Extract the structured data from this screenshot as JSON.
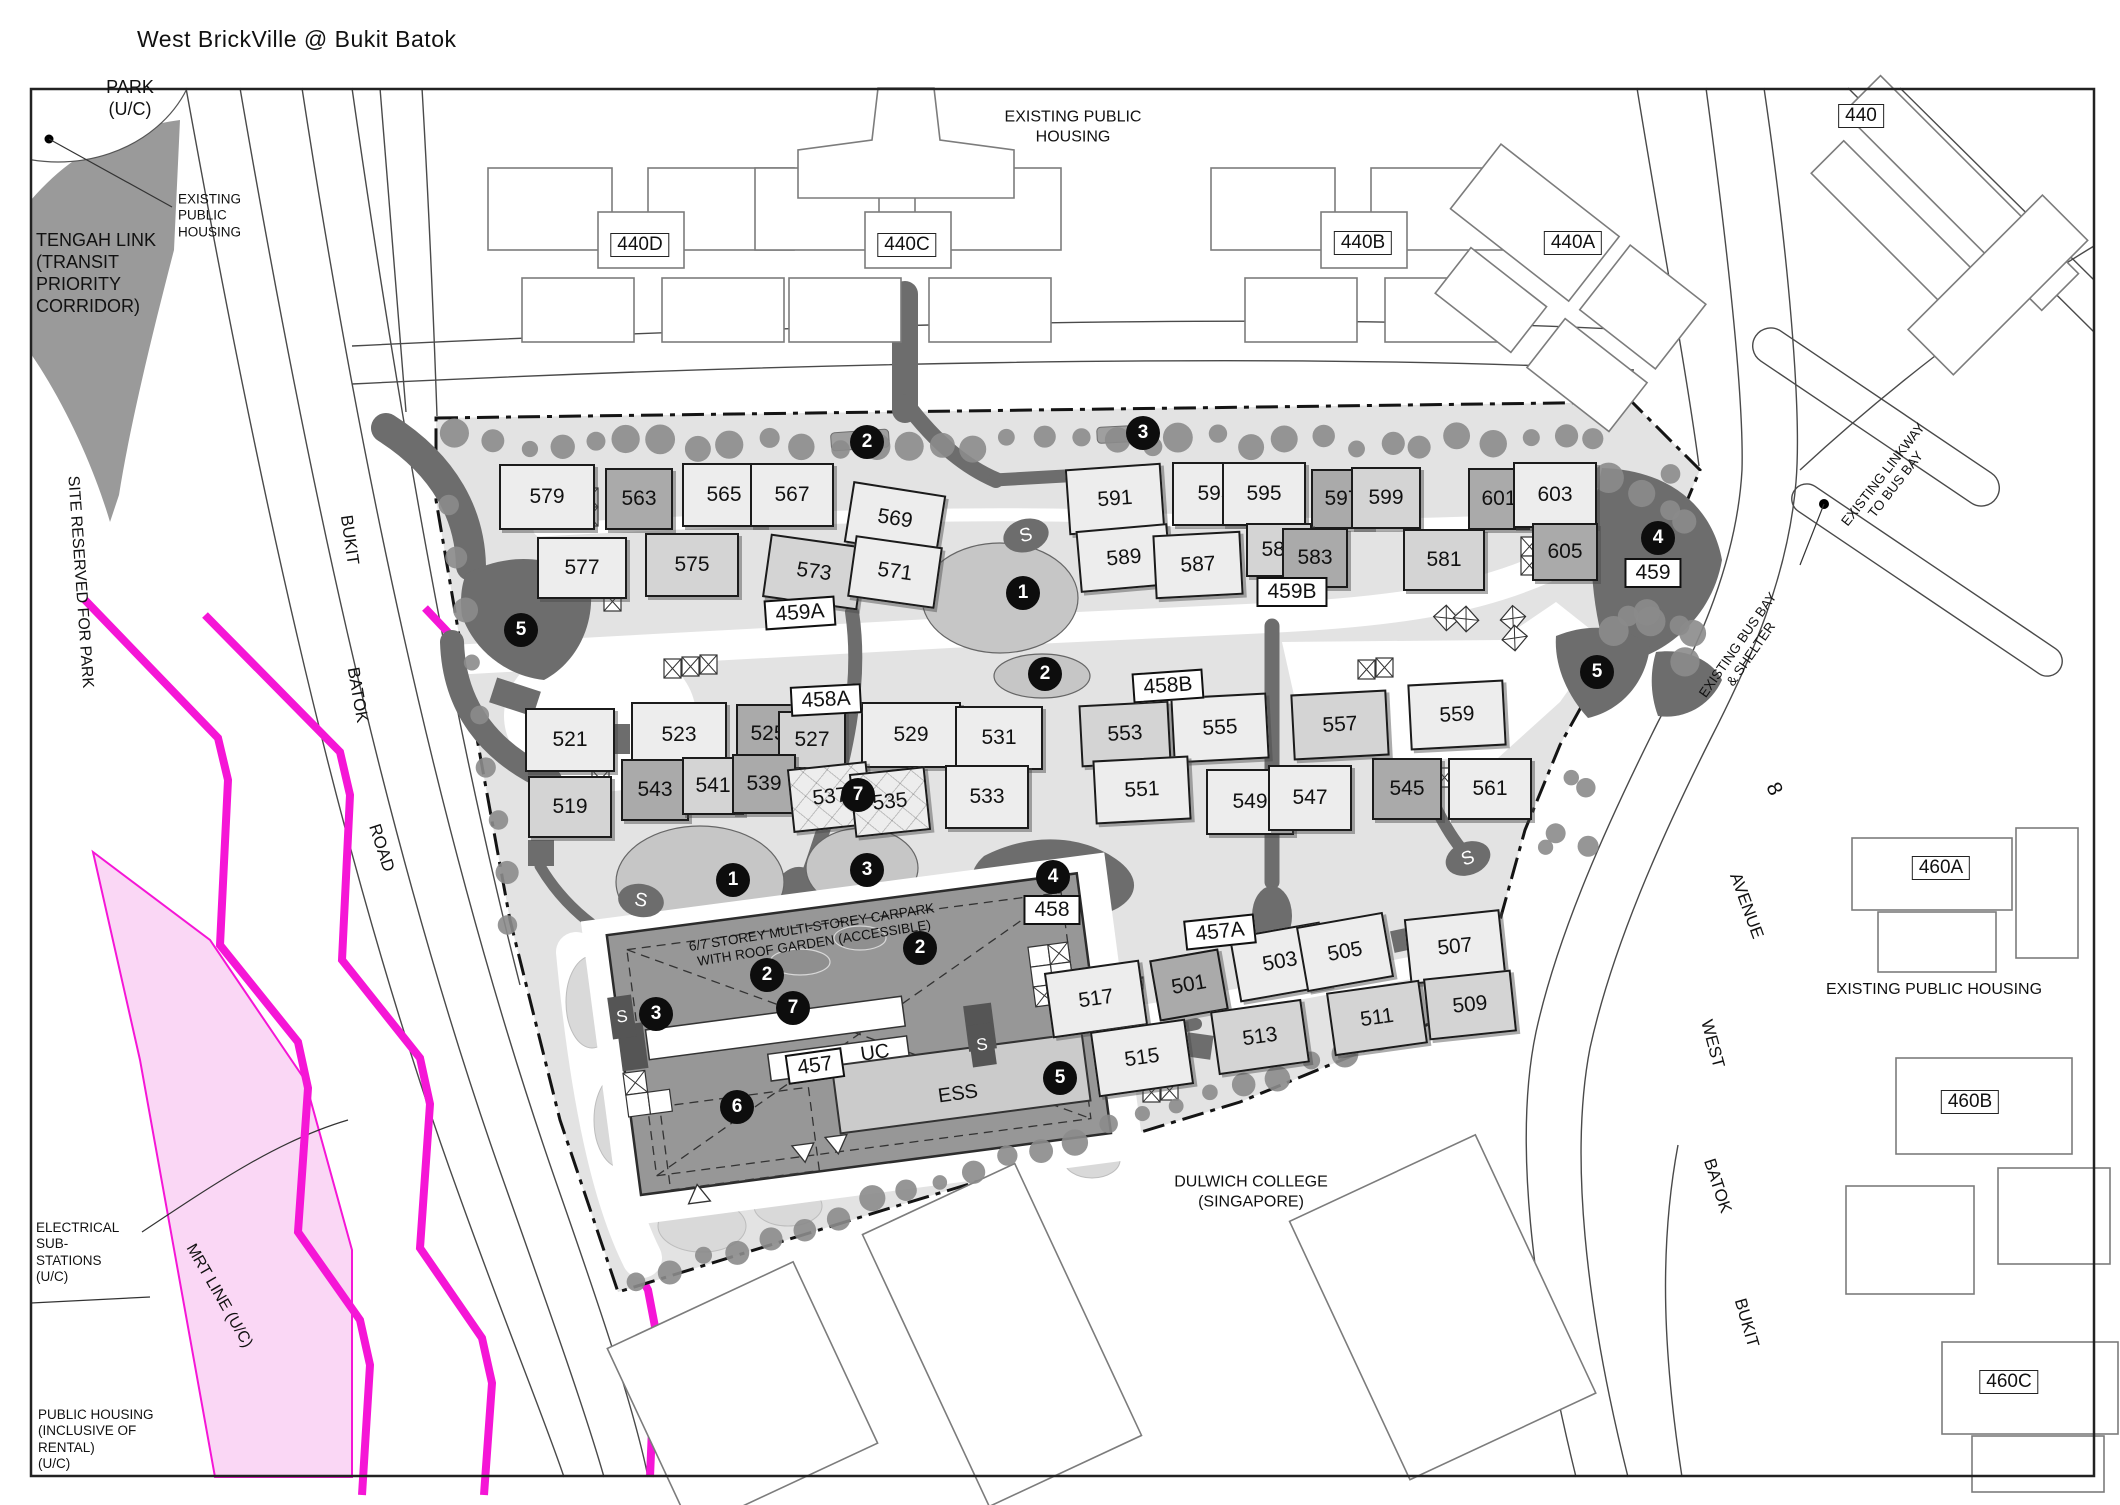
{
  "title": "West BrickVille @ Bukit Batok",
  "colors": {
    "mrt_line": "#f516d6",
    "mrt_band": "#fad7f5",
    "tengah_gray": "#9a9a9a",
    "site_fill": "#e3e3e3",
    "path_dark": "#6d6d6d",
    "tree": "#8b8b8b",
    "marker_bg": "#0d0d0d"
  },
  "s_label": "S",
  "labels": [
    {
      "id": "park",
      "lines": [
        "PARK",
        "(U/C)"
      ],
      "x": 130,
      "y": 99,
      "size": 18,
      "rot": 0,
      "align": "center"
    },
    {
      "id": "tengah-link",
      "lines": [
        "TENGAH LINK",
        "(TRANSIT",
        "PRIORITY",
        "CORRIDOR)"
      ],
      "x": 36,
      "y": 274,
      "size": 18,
      "rot": 0,
      "align": "left"
    },
    {
      "id": "existing-public-housing-callout",
      "lines": [
        "EXISTING",
        "PUBLIC",
        "HOUSING"
      ],
      "x": 178,
      "y": 216,
      "size": 13.5,
      "rot": 0,
      "align": "left"
    },
    {
      "id": "site-reserved-for-park",
      "lines": [
        "SITE RESERVED FOR PARK"
      ],
      "x": 80,
      "y": 582,
      "size": 16,
      "rot": 86,
      "align": "center"
    },
    {
      "id": "bukit-left",
      "lines": [
        "BUKIT"
      ],
      "x": 349,
      "y": 540,
      "size": 17,
      "rot": 82,
      "align": "center"
    },
    {
      "id": "batok-left",
      "lines": [
        "BATOK"
      ],
      "x": 357,
      "y": 695,
      "size": 17,
      "rot": 80,
      "align": "center"
    },
    {
      "id": "road-left",
      "lines": [
        "ROAD"
      ],
      "x": 381,
      "y": 848,
      "size": 17,
      "rot": 72,
      "align": "center"
    },
    {
      "id": "electrical-substations",
      "lines": [
        "ELECTRICAL",
        "SUB-",
        "STATIONS",
        "(U/C)"
      ],
      "x": 36,
      "y": 1253,
      "size": 13.5,
      "rot": 0,
      "align": "left"
    },
    {
      "id": "mrt-line",
      "lines": [
        "MRT LINE (U/C)"
      ],
      "x": 219,
      "y": 1296,
      "size": 16,
      "rot": 60,
      "align": "center"
    },
    {
      "id": "public-housing-rental",
      "lines": [
        "PUBLIC HOUSING",
        "(INCLUSIVE OF",
        "RENTAL)",
        "(U/C)"
      ],
      "x": 38,
      "y": 1440,
      "size": 13.5,
      "rot": 0,
      "align": "left"
    },
    {
      "id": "existing-public-housing-top",
      "lines": [
        "EXISTING PUBLIC",
        "HOUSING"
      ],
      "x": 1073,
      "y": 127,
      "size": 16,
      "rot": 0,
      "align": "center"
    },
    {
      "id": "existing-public-housing-right",
      "lines": [
        "EXISTING PUBLIC HOUSING"
      ],
      "x": 1934,
      "y": 990,
      "size": 16,
      "rot": 0,
      "align": "center"
    },
    {
      "id": "dulwich-college",
      "lines": [
        "DULWICH COLLEGE",
        "(SINGAPORE)"
      ],
      "x": 1251,
      "y": 1192,
      "size": 16,
      "rot": 0,
      "align": "center"
    },
    {
      "id": "existing-linkway",
      "lines": [
        "EXISTING LINKWAY",
        "TO BUS BAY"
      ],
      "x": 1890,
      "y": 480,
      "size": 13.5,
      "rot": -52,
      "align": "center"
    },
    {
      "id": "existing-bus-bay",
      "lines": [
        "EXISTING BUS BAY",
        "& SHELTER"
      ],
      "x": 1745,
      "y": 650,
      "size": 13.5,
      "rot": -55,
      "align": "center"
    },
    {
      "id": "avenue-8",
      "lines": [
        "8"
      ],
      "x": 1774,
      "y": 789,
      "size": 21,
      "rot": 65,
      "align": "center"
    },
    {
      "id": "avenue",
      "lines": [
        "AVENUE"
      ],
      "x": 1746,
      "y": 906,
      "size": 17,
      "rot": 70,
      "align": "center"
    },
    {
      "id": "west",
      "lines": [
        "WEST"
      ],
      "x": 1712,
      "y": 1044,
      "size": 17,
      "rot": 75,
      "align": "center"
    },
    {
      "id": "batok-right",
      "lines": [
        "BATOK"
      ],
      "x": 1717,
      "y": 1186,
      "size": 17,
      "rot": 72,
      "align": "center"
    },
    {
      "id": "bukit-right",
      "lines": [
        "BUKIT"
      ],
      "x": 1746,
      "y": 1323,
      "size": 17,
      "rot": 74,
      "align": "center"
    },
    {
      "id": "carpark",
      "lines": [
        "6/7 STOREY MULTI-STOREY CARPARK",
        "WITH ROOF GARDEN (ACCESSIBLE)"
      ],
      "x": 813,
      "y": 936,
      "size": 13.5,
      "rot": -9,
      "align": "center"
    },
    {
      "id": "uc",
      "lines": [
        "UC"
      ],
      "x": 875,
      "y": 1053,
      "size": 20,
      "rot": -8,
      "align": "center"
    },
    {
      "id": "ess",
      "lines": [
        "ESS"
      ],
      "x": 958,
      "y": 1094,
      "size": 20,
      "rot": -8,
      "align": "center"
    }
  ],
  "buildings": [
    {
      "label": "579",
      "x": 545,
      "y": 495,
      "w": 92,
      "h": 62,
      "rot": 0,
      "shade": "light"
    },
    {
      "label": "563",
      "x": 637,
      "y": 497,
      "w": 64,
      "h": 58,
      "rot": 0,
      "shade": "dark"
    },
    {
      "label": "565",
      "x": 722,
      "y": 493,
      "w": 80,
      "h": 60,
      "rot": 0,
      "shade": "light"
    },
    {
      "label": "567",
      "x": 790,
      "y": 493,
      "w": 80,
      "h": 60,
      "rot": 0,
      "shade": "light"
    },
    {
      "label": "569",
      "x": 893,
      "y": 517,
      "w": 90,
      "h": 58,
      "rot": 9,
      "shade": "light"
    },
    {
      "label": "591",
      "x": 1113,
      "y": 497,
      "w": 92,
      "h": 62,
      "rot": -4,
      "shade": "light"
    },
    {
      "label": "593",
      "x": 1213,
      "y": 492,
      "w": 82,
      "h": 60,
      "rot": 0,
      "shade": "light"
    },
    {
      "label": "595",
      "x": 1262,
      "y": 492,
      "w": 80,
      "h": 60,
      "rot": 0,
      "shade": "light"
    },
    {
      "label": "597",
      "x": 1340,
      "y": 497,
      "w": 58,
      "h": 56,
      "rot": 0,
      "shade": "dark"
    },
    {
      "label": "599",
      "x": 1384,
      "y": 496,
      "w": 66,
      "h": 58,
      "rot": 0,
      "shade": "mid"
    },
    {
      "label": "601",
      "x": 1497,
      "y": 497,
      "w": 58,
      "h": 58,
      "rot": 0,
      "shade": "dark"
    },
    {
      "label": "603",
      "x": 1553,
      "y": 493,
      "w": 80,
      "h": 62,
      "rot": 0,
      "shade": "light"
    },
    {
      "label": "577",
      "x": 580,
      "y": 566,
      "w": 86,
      "h": 58,
      "rot": 0,
      "shade": "light"
    },
    {
      "label": "575",
      "x": 690,
      "y": 563,
      "w": 90,
      "h": 60,
      "rot": 0,
      "shade": "mid"
    },
    {
      "label": "573",
      "x": 812,
      "y": 570,
      "w": 92,
      "h": 60,
      "rot": 8,
      "shade": "mid"
    },
    {
      "label": "571",
      "x": 893,
      "y": 570,
      "w": 84,
      "h": 58,
      "rot": 8,
      "shade": "light"
    },
    {
      "label": "589",
      "x": 1122,
      "y": 556,
      "w": 88,
      "h": 58,
      "rot": -5,
      "shade": "light"
    },
    {
      "label": "587",
      "x": 1196,
      "y": 563,
      "w": 84,
      "h": 60,
      "rot": -3,
      "shade": "light"
    },
    {
      "label": "585",
      "x": 1277,
      "y": 548,
      "w": 62,
      "h": 50,
      "rot": 0,
      "shade": "mid"
    },
    {
      "label": "583",
      "x": 1313,
      "y": 556,
      "w": 62,
      "h": 56,
      "rot": 0,
      "shade": "dark"
    },
    {
      "label": "581",
      "x": 1442,
      "y": 558,
      "w": 78,
      "h": 58,
      "rot": 0,
      "shade": "mid"
    },
    {
      "label": "605",
      "x": 1563,
      "y": 550,
      "w": 62,
      "h": 54,
      "rot": 0,
      "shade": "dark"
    },
    {
      "label": "521",
      "x": 568,
      "y": 738,
      "w": 86,
      "h": 60,
      "rot": 0,
      "shade": "light"
    },
    {
      "label": "523",
      "x": 677,
      "y": 733,
      "w": 92,
      "h": 62,
      "rot": 0,
      "shade": "light"
    },
    {
      "label": "525",
      "x": 766,
      "y": 732,
      "w": 60,
      "h": 56,
      "rot": 0,
      "shade": "dark"
    },
    {
      "label": "527",
      "x": 810,
      "y": 738,
      "w": 64,
      "h": 54,
      "rot": 0,
      "shade": "mid"
    },
    {
      "label": "529",
      "x": 909,
      "y": 733,
      "w": 96,
      "h": 62,
      "rot": 0,
      "shade": "light"
    },
    {
      "label": "531",
      "x": 997,
      "y": 736,
      "w": 84,
      "h": 60,
      "rot": 0,
      "shade": "light"
    },
    {
      "label": "553",
      "x": 1123,
      "y": 732,
      "w": 86,
      "h": 58,
      "rot": -3,
      "shade": "mid"
    },
    {
      "label": "555",
      "x": 1218,
      "y": 726,
      "w": 92,
      "h": 62,
      "rot": -3,
      "shade": "light"
    },
    {
      "label": "557",
      "x": 1338,
      "y": 723,
      "w": 92,
      "h": 62,
      "rot": -3,
      "shade": "mid"
    },
    {
      "label": "559",
      "x": 1455,
      "y": 713,
      "w": 92,
      "h": 62,
      "rot": -3,
      "shade": "light"
    },
    {
      "label": "519",
      "x": 568,
      "y": 805,
      "w": 80,
      "h": 58,
      "rot": 0,
      "shade": "mid"
    },
    {
      "label": "543",
      "x": 653,
      "y": 788,
      "w": 64,
      "h": 58,
      "rot": 0,
      "shade": "dark"
    },
    {
      "label": "541",
      "x": 711,
      "y": 784,
      "w": 58,
      "h": 54,
      "rot": 0,
      "shade": "mid"
    },
    {
      "label": "539",
      "x": 762,
      "y": 782,
      "w": 60,
      "h": 56,
      "rot": 0,
      "shade": "dark"
    },
    {
      "label": "537",
      "x": 828,
      "y": 795,
      "w": 76,
      "h": 60,
      "rot": -6,
      "shade": "light",
      "hatched": true
    },
    {
      "label": "535",
      "x": 888,
      "y": 800,
      "w": 72,
      "h": 60,
      "rot": -6,
      "shade": "light",
      "hatched": true
    },
    {
      "label": "533",
      "x": 985,
      "y": 795,
      "w": 80,
      "h": 60,
      "rot": 0,
      "shade": "light"
    },
    {
      "label": "551",
      "x": 1140,
      "y": 788,
      "w": 92,
      "h": 60,
      "rot": -3,
      "shade": "light"
    },
    {
      "label": "549",
      "x": 1248,
      "y": 800,
      "w": 84,
      "h": 62,
      "rot": 0,
      "shade": "light"
    },
    {
      "label": "547",
      "x": 1308,
      "y": 796,
      "w": 80,
      "h": 62,
      "rot": 0,
      "shade": "light"
    },
    {
      "label": "545",
      "x": 1405,
      "y": 787,
      "w": 66,
      "h": 58,
      "rot": 0,
      "shade": "dark"
    },
    {
      "label": "561",
      "x": 1488,
      "y": 787,
      "w": 80,
      "h": 58,
      "rot": 0,
      "shade": "light"
    },
    {
      "label": "517",
      "x": 1094,
      "y": 997,
      "w": 92,
      "h": 62,
      "rot": -8,
      "shade": "light"
    },
    {
      "label": "501",
      "x": 1187,
      "y": 983,
      "w": 66,
      "h": 58,
      "rot": -10,
      "shade": "dark"
    },
    {
      "label": "503",
      "x": 1278,
      "y": 960,
      "w": 88,
      "h": 62,
      "rot": -10,
      "shade": "light"
    },
    {
      "label": "505",
      "x": 1343,
      "y": 950,
      "w": 84,
      "h": 62,
      "rot": -10,
      "shade": "light"
    },
    {
      "label": "507",
      "x": 1453,
      "y": 945,
      "w": 92,
      "h": 62,
      "rot": -6,
      "shade": "light"
    },
    {
      "label": "509",
      "x": 1468,
      "y": 1003,
      "w": 84,
      "h": 58,
      "rot": -6,
      "shade": "mid"
    },
    {
      "label": "511",
      "x": 1375,
      "y": 1016,
      "w": 90,
      "h": 60,
      "rot": -8,
      "shade": "mid"
    },
    {
      "label": "513",
      "x": 1258,
      "y": 1035,
      "w": 88,
      "h": 60,
      "rot": -8,
      "shade": "mid"
    },
    {
      "label": "515",
      "x": 1140,
      "y": 1056,
      "w": 92,
      "h": 62,
      "rot": -8,
      "shade": "light"
    }
  ],
  "unit_labels": [
    {
      "label": "459A",
      "x": 800,
      "y": 613,
      "rot": -4
    },
    {
      "label": "458A",
      "x": 826,
      "y": 700,
      "rot": -3
    },
    {
      "label": "459B",
      "x": 1292,
      "y": 592,
      "rot": 0
    },
    {
      "label": "458B",
      "x": 1168,
      "y": 686,
      "rot": -4
    },
    {
      "label": "457A",
      "x": 1220,
      "y": 932,
      "rot": -6
    },
    {
      "label": "457",
      "x": 815,
      "y": 1066,
      "rot": -8
    },
    {
      "label": "459",
      "x": 1653,
      "y": 573,
      "rot": 0
    },
    {
      "label": "458",
      "x": 1052,
      "y": 910,
      "rot": 0
    }
  ],
  "estate_labels": [
    {
      "label": "440D",
      "x": 640,
      "y": 245
    },
    {
      "label": "440C",
      "x": 907,
      "y": 245
    },
    {
      "label": "440B",
      "x": 1363,
      "y": 243
    },
    {
      "label": "440A",
      "x": 1573,
      "y": 243
    },
    {
      "label": "440",
      "x": 1861,
      "y": 116
    },
    {
      "label": "460A",
      "x": 1941,
      "y": 868
    },
    {
      "label": "460B",
      "x": 1970,
      "y": 1102
    },
    {
      "label": "460C",
      "x": 2009,
      "y": 1382
    }
  ],
  "markers": [
    {
      "n": "2",
      "x": 867,
      "y": 442
    },
    {
      "n": "3",
      "x": 1143,
      "y": 433
    },
    {
      "n": "5",
      "x": 521,
      "y": 630
    },
    {
      "n": "1",
      "x": 1023,
      "y": 593
    },
    {
      "n": "2",
      "x": 1045,
      "y": 674
    },
    {
      "n": "7",
      "x": 858,
      "y": 795
    },
    {
      "n": "1",
      "x": 733,
      "y": 880
    },
    {
      "n": "3",
      "x": 867,
      "y": 870
    },
    {
      "n": "4",
      "x": 1053,
      "y": 877
    },
    {
      "n": "2",
      "x": 920,
      "y": 948
    },
    {
      "n": "2",
      "x": 767,
      "y": 975
    },
    {
      "n": "3",
      "x": 656,
      "y": 1014
    },
    {
      "n": "7",
      "x": 793,
      "y": 1008
    },
    {
      "n": "6",
      "x": 737,
      "y": 1107
    },
    {
      "n": "5",
      "x": 1060,
      "y": 1078
    },
    {
      "n": "5",
      "x": 1597,
      "y": 672
    },
    {
      "n": "4",
      "x": 1658,
      "y": 538
    }
  ],
  "s_markers": [
    {
      "x": 1026,
      "y": 535,
      "shape": "ellipse",
      "rot": -15
    },
    {
      "x": 641,
      "y": 900,
      "shape": "ellipse",
      "rot": 10
    },
    {
      "x": 1468,
      "y": 858,
      "shape": "ellipse",
      "rot": -20
    },
    {
      "x": 622,
      "y": 1017,
      "shape": "square",
      "rot": -8
    },
    {
      "x": 982,
      "y": 1045,
      "shape": "square",
      "rot": -8
    }
  ]
}
